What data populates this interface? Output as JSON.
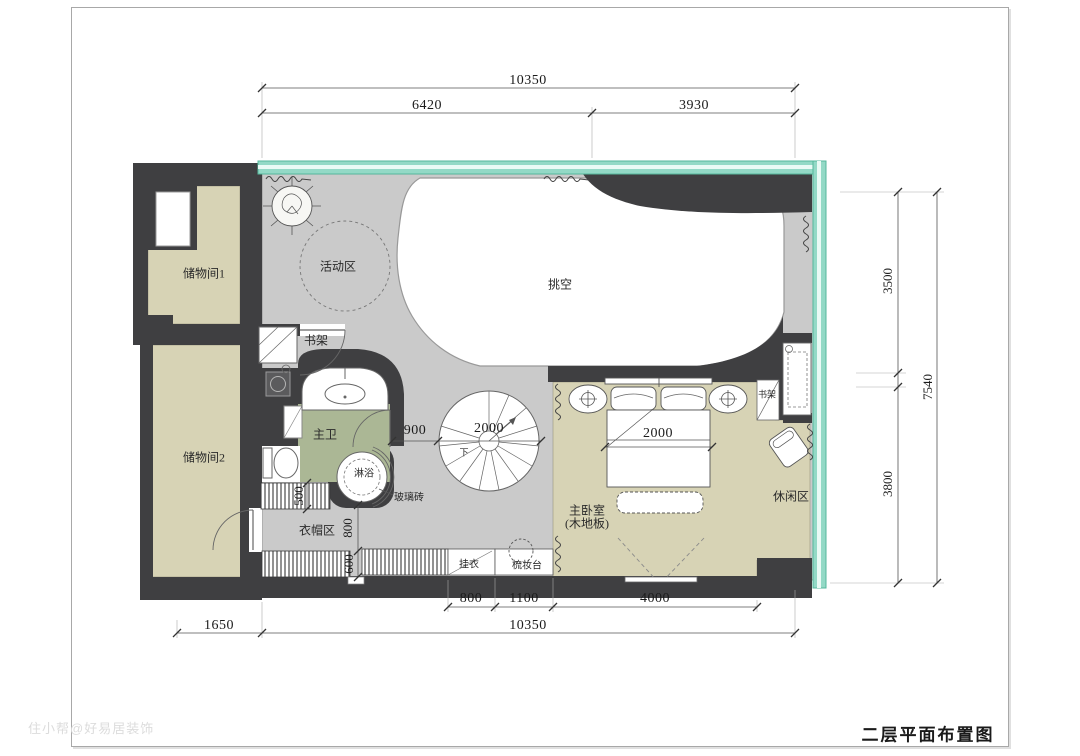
{
  "title": "二层平面布置图",
  "watermark": "住小帮@好易居装饰",
  "colors": {
    "wall": "#3f3f41",
    "floor_gray": "#cacaca",
    "floor_olive": "#d7d3b5",
    "floor_bath_green": "#abb795",
    "glass_teal": "#93d9c6",
    "void_white": "#ffffff"
  },
  "rooms": {
    "storage1": "储物间1",
    "storage2": "储物间2",
    "activity": "活动区",
    "void": "挑空",
    "bookshelf_top": "书架",
    "bookshelf_right": "书架",
    "master_bath": "主卫",
    "shower": "淋浴",
    "glass_brick": "玻璃砖",
    "cloakroom": "衣帽区",
    "hang_clothes": "挂衣",
    "dressing_table": "梳妆台",
    "master_bedroom": "主卧室",
    "master_bedroom_floor": "(木地板)",
    "leisure": "休闲区",
    "stair_down": "下"
  },
  "dimensions": {
    "top_total": "10350",
    "top_left": "6420",
    "top_right": "3930",
    "right_upper": "3500",
    "right_total": "7540",
    "right_lower": "3800",
    "bottom_hang": "800",
    "bottom_dresser": "1100",
    "bottom_bedroom": "4000",
    "bottom_offset": "1650",
    "bottom_total": "10350",
    "bath_corridor": "900",
    "stair_diameter": "2000",
    "bed_width": "2000",
    "wardrobe_depth": "500",
    "closet_corridor": "800",
    "closet_depth": "600"
  }
}
